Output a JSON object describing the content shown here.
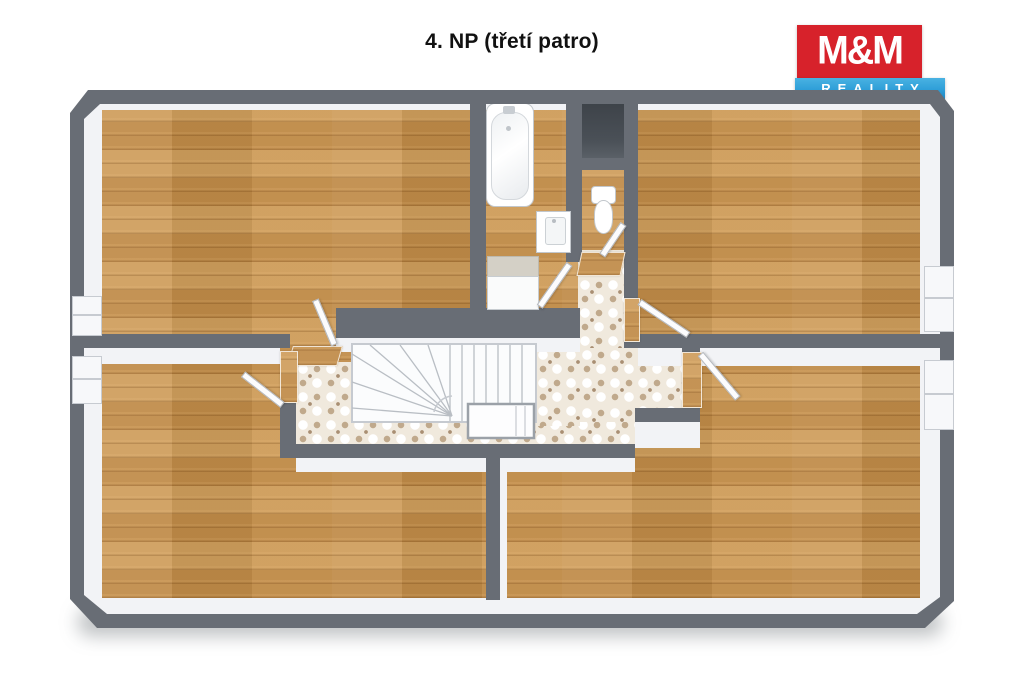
{
  "title": "4. NP (třetí patro)",
  "logo": {
    "top": "M&M",
    "bottom": "REALITY",
    "red": "#d7222b",
    "blue": "#2f9fd8"
  },
  "plan": {
    "wall_color": "#686d75",
    "wood_color": "#c8934e",
    "tile_color": "#f0e9dd",
    "shaft_color": "#454b52",
    "rooms": [
      {
        "name": "room-top-left",
        "floor": "wood"
      },
      {
        "name": "room-top-right",
        "floor": "wood"
      },
      {
        "name": "room-bottom-left",
        "floor": "wood"
      },
      {
        "name": "room-bottom-right",
        "floor": "wood"
      },
      {
        "name": "bathroom",
        "floor": "wood",
        "fixtures": [
          "bathtub",
          "washbasin",
          "shower"
        ]
      },
      {
        "name": "wc",
        "floor": "wood",
        "fixtures": [
          "toilet"
        ]
      },
      {
        "name": "hallway",
        "floor": "patterned-tile",
        "fixtures": [
          "staircase"
        ]
      },
      {
        "name": "shaft",
        "floor": "void"
      }
    ],
    "window_count": 4,
    "door_count": 6
  }
}
